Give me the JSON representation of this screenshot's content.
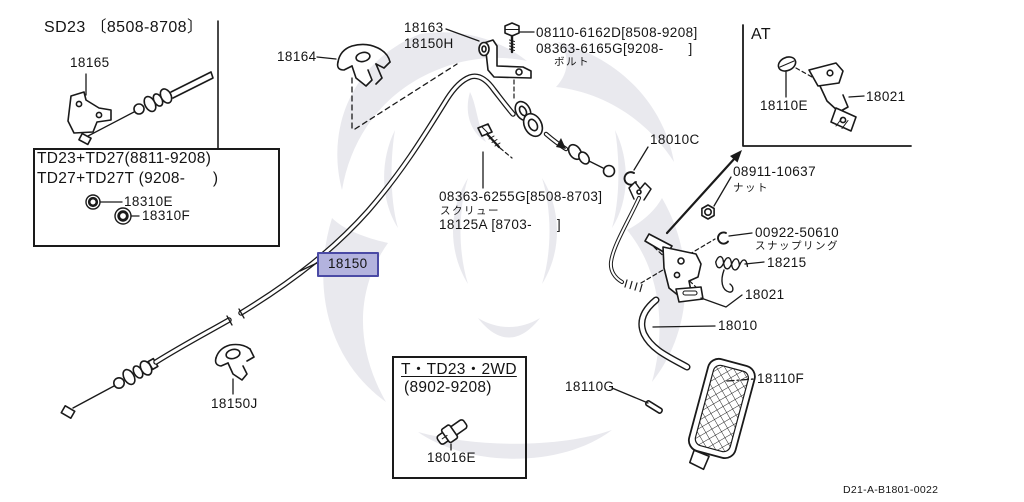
{
  "colors": {
    "line": "#1a1a1a",
    "highlight_bg": "#b3b3de",
    "highlight_border": "#4a4aa5",
    "watermark": "#e9e9ee"
  },
  "selected_part": "18150",
  "diagram_code": "D21-A-B1801-0022",
  "boxes": {
    "sd23": {
      "title": "SD23 〔8508-8708〕"
    },
    "td23": {
      "line1": "TD23+TD27(8811-9208)",
      "line2": "TD27+TD27T (9208-      )"
    },
    "t_td23": {
      "line1": "T・TD23・2WD",
      "line2": "(8902-9208)"
    },
    "at": {
      "title": "AT"
    }
  },
  "parts": {
    "p18165": "18165",
    "p18310E": "18310E",
    "p18310F": "18310F",
    "p18164": "18164",
    "p18163": "18163",
    "p18150H": "18150H",
    "bolt_pn1": "08110-6162D[8508-9208]",
    "bolt_pn2": "08363-6165G[9208-      ]",
    "p18110E": "18110E",
    "p18021_at": "18021",
    "p18010C": "18010C",
    "nut_pn": "08911-10637",
    "screw_pn": "08363-6255G[8508-8703]",
    "p18125A": "18125A [8703-      ]",
    "snap_pn": "00922-50610",
    "p18215": "18215",
    "p18021": "18021",
    "p18010": "18010",
    "p18150": "18150",
    "p18150J": "18150J",
    "p18016E": "18016E",
    "p18110G": "18110G",
    "p18110F": "18110F"
  },
  "annotations": {
    "bolt": "ボルト",
    "nut": "ナット",
    "screw": "スクリュー",
    "snap_ring": "スナップリング"
  }
}
